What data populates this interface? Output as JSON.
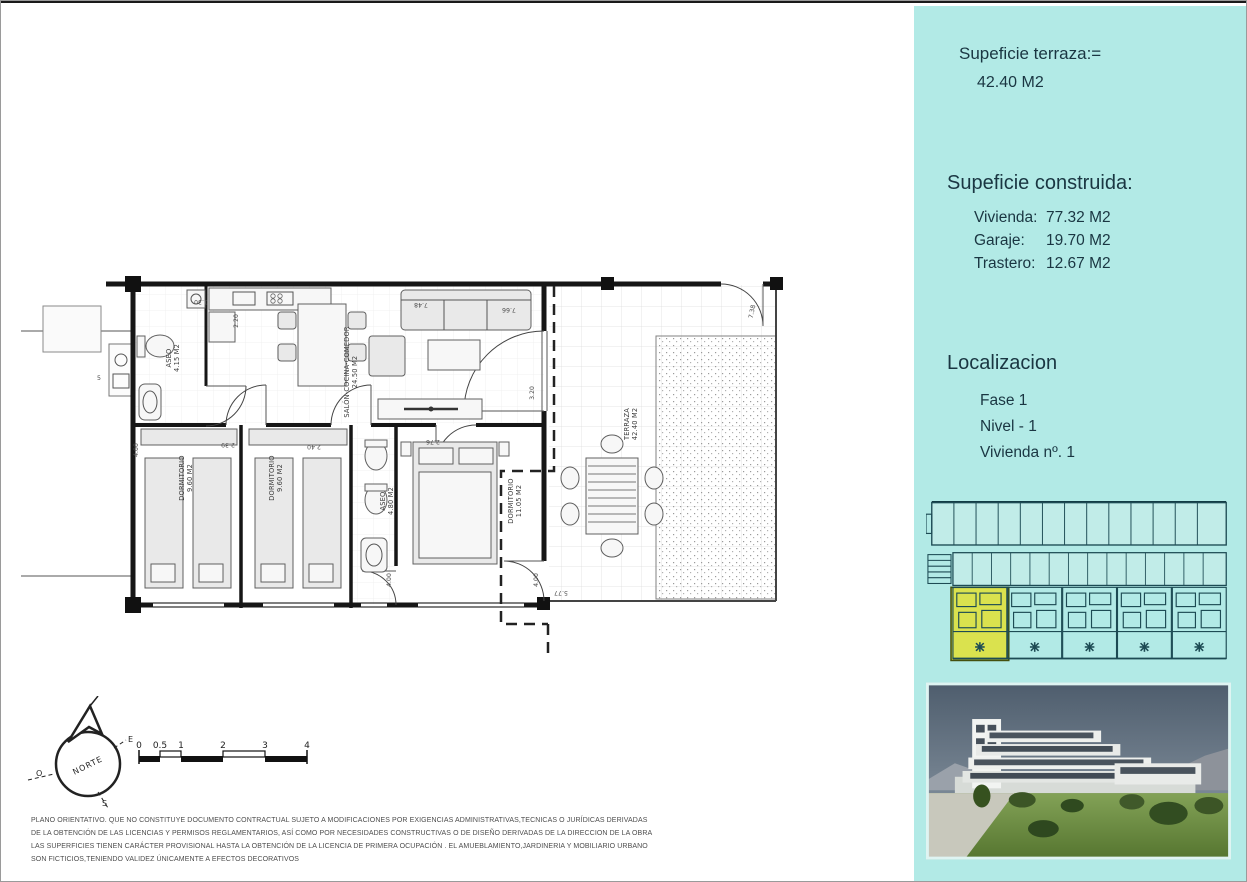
{
  "colors": {
    "sidebar_bg": "#b2eae6",
    "sidebar_text": "#1a3642",
    "highlight_yellow": "#dae24e",
    "siteplan_line": "#1d4b54"
  },
  "sidebar": {
    "terrace_title": "Supeficie terraza:=",
    "terrace_value": "42.40 M2",
    "built_title": "Supeficie construida:",
    "built_rows": [
      {
        "label": "Vivienda:",
        "value": "77.32 M2"
      },
      {
        "label": "Garaje:",
        "value": "19.70 M2"
      },
      {
        "label": "Trastero:",
        "value": "12.67 M2"
      }
    ],
    "location_title": "Localizacion",
    "location_rows": [
      "Fase 1",
      "Nivel - 1",
      "Vivienda nº. 1"
    ]
  },
  "plan": {
    "rooms": [
      {
        "name": "ASEO",
        "area": "4.15 M2"
      },
      {
        "name": "SALÓN-COCINA-COMEDOR",
        "area": "24.50 M2"
      },
      {
        "name": "DORMITORIO",
        "area": "9.60 M2"
      },
      {
        "name": "DORMITORIO",
        "area": "9.60 M2"
      },
      {
        "name": "ASEO",
        "area": "4.80 M2"
      },
      {
        "name": "DORMITORIO",
        "area": "11.05 M2"
      },
      {
        "name": "TERRAZA",
        "area": "42.40 M2"
      }
    ],
    "dimensions": [
      "7.48",
      "7.66",
      "1.30",
      "2.20",
      "3.20",
      "2.76",
      "2.39",
      "2.40",
      "4.00",
      "4.00",
      "4.00",
      "5.77",
      "7.38",
      "5"
    ]
  },
  "compass": {
    "north_label": "NORTE",
    "east": "E",
    "west": "O",
    "south": "S"
  },
  "scalebar": {
    "labels": [
      "0",
      "0.5",
      "1",
      "2",
      "3",
      "4"
    ]
  },
  "disclaimer": {
    "lines": [
      "PLANO ORIENTATIVO. QUE NO CONSTITUYE DOCUMENTO CONTRACTUAL SUJETO A MODIFICACIONES POR EXIGENCIAS ADMINISTRATIVAS,TECNICAS O JURÍDICAS DERIVADAS",
      "DE LA OBTENCIÓN DE LAS LICENCIAS Y PERMISOS REGLAMENTARIOS, ASÍ COMO POR NECESIDADES CONSTRUCTIVAS  O DE DISEÑO DERIVADAS DE LA DIRECCION DE LA OBRA",
      "LAS SUPERFICIES TIENEN CARÁCTER PROVISIONAL HASTA LA OBTENCIÓN DE LA LICENCIA DE PRIMERA OCUPACIÓN . EL AMUEBLAMIENTO,JARDINERIA Y MOBILIARIO URBANO",
      "SON FICTICIOS,TENIENDO VALIDEZ ÚNICAMENTE  A EFECTOS DECORATIVOS"
    ]
  }
}
